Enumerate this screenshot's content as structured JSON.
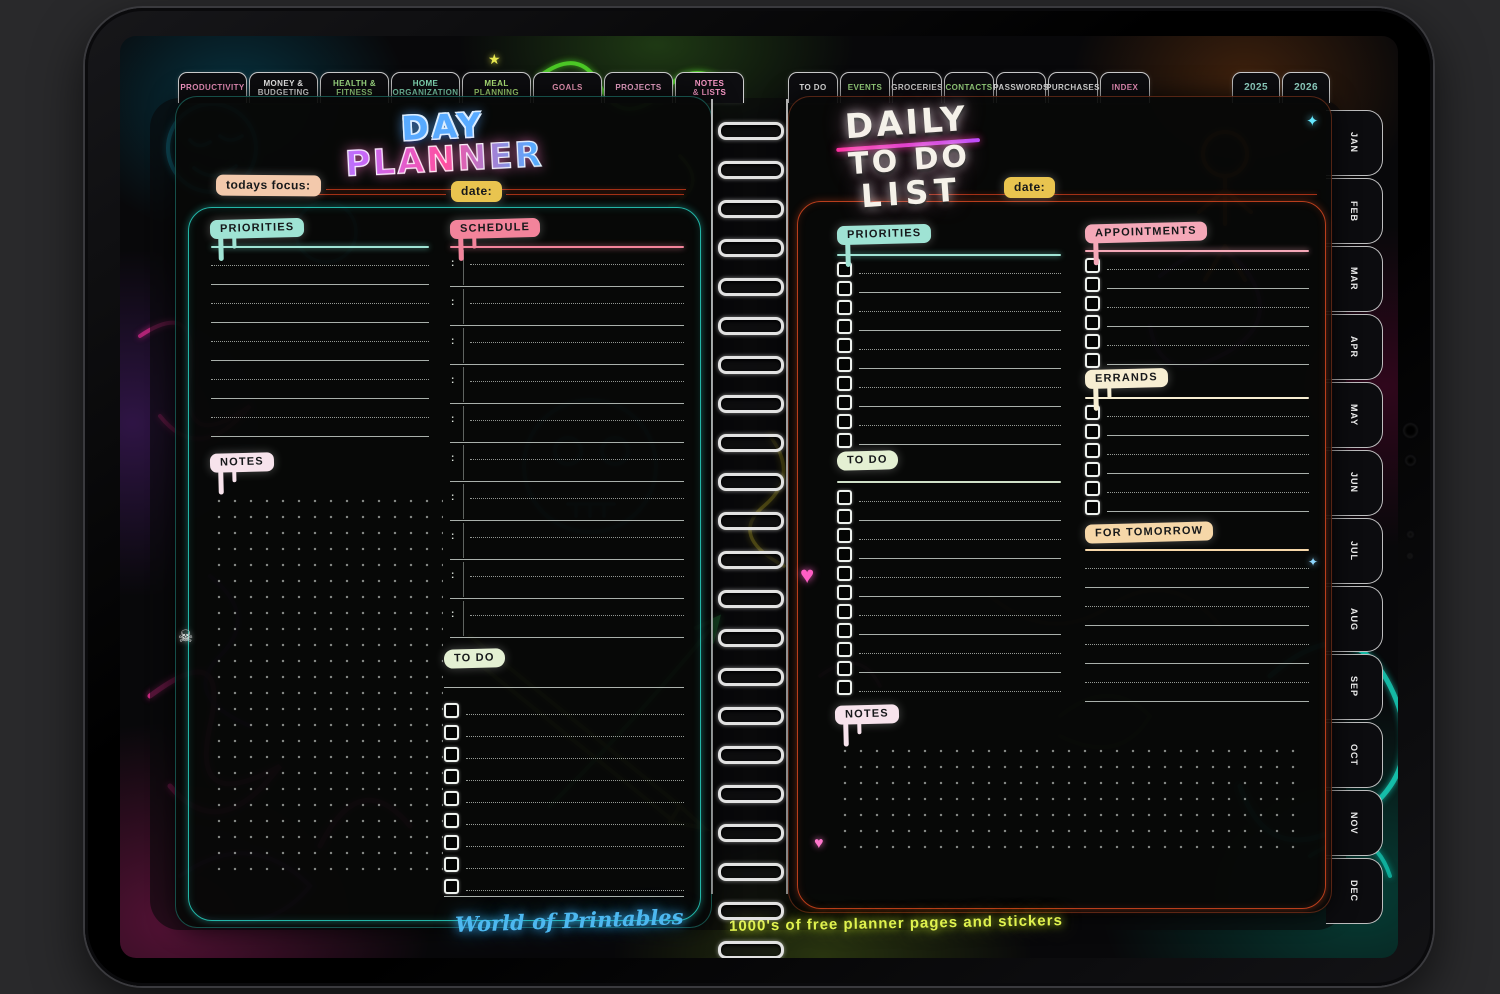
{
  "top_tabs_left": [
    {
      "label": "PRODUCTIVITY",
      "color": "#ff9ccb"
    },
    {
      "label": "MONEY &\nBUDGETING",
      "color": "#f3f3f3"
    },
    {
      "label": "HEALTH &\nFITNESS",
      "color": "#a8e98c"
    },
    {
      "label": "HOME\nORGANIZATION",
      "color": "#8ce9c2"
    },
    {
      "label": "MEAL\nPLANNING",
      "color": "#b6ef7e"
    },
    {
      "label": "GOALS",
      "color": "#ffa3c6"
    },
    {
      "label": "PROJECTS",
      "color": "#ffb0d9"
    },
    {
      "label": "NOTES\n& LISTS",
      "color": "#ff9ccb"
    }
  ],
  "top_tabs_right": [
    {
      "label": "TO DO",
      "color": "#f3f3f3"
    },
    {
      "label": "EVENTS",
      "color": "#a8e98c"
    },
    {
      "label": "GROCERIES",
      "color": "#e6e6e6"
    },
    {
      "label": "CONTACTS",
      "color": "#a8e98c"
    },
    {
      "label": "PASSWORDS",
      "color": "#f3f3f3"
    },
    {
      "label": "PURCHASES",
      "color": "#f3f3f3"
    },
    {
      "label": "INDEX",
      "color": "#ff9ccb"
    }
  ],
  "year_tabs": [
    {
      "label": "2025",
      "color": "#9fe8d8"
    },
    {
      "label": "2026",
      "color": "#9fe8d8"
    }
  ],
  "month_tabs": [
    "JAN",
    "FEB",
    "MAR",
    "APR",
    "MAY",
    "JUN",
    "JUL",
    "AUG",
    "SEP",
    "OCT",
    "NOV",
    "DEC"
  ],
  "left_page": {
    "title_line1": "DAY",
    "title_line2": "PLANNER",
    "focus_label": "todays focus:",
    "date_label": "date:",
    "priorities": {
      "label": "PRIORITIES",
      "accent": "#9fe3d4",
      "rows": 10
    },
    "schedule": {
      "label": "SCHEDULE",
      "accent": "#f2849b",
      "rows": 10
    },
    "notes": {
      "label": "NOTES",
      "accent": "#f7e3ec"
    },
    "todo": {
      "label": "TO DO",
      "accent": "#e4f0d3",
      "rows": 9
    }
  },
  "right_page": {
    "title_line1": "DAILY",
    "title_line2": "TO DO",
    "title_line3": "LIST",
    "date_label": "date:",
    "priorities": {
      "label": "PRIORITIES",
      "accent": "#9fe3d4",
      "rows": 10
    },
    "todo": {
      "label": "TO DO",
      "accent": "#e4f0d3",
      "rows": 11
    },
    "notes": {
      "label": "NOTES",
      "accent": "#f7e3ec"
    },
    "appointments": {
      "label": "APPOINTMENTS",
      "accent": "#f5a8b8",
      "rows": 6
    },
    "errands": {
      "label": "ERRANDS",
      "accent": "#f7eed2",
      "rows": 6
    },
    "tomorrow": {
      "label": "FOR TOMORROW",
      "accent": "#f6d7a8",
      "rows": 8
    }
  },
  "footer": {
    "brand": "World of Printables",
    "tagline": "1000's of free planner pages and stickers"
  },
  "colors": {
    "left_page_border": "#28d3c3",
    "right_page_border": "#d84820",
    "date_badge": "#e9c44f",
    "focus_badge": "#f3c9ac"
  },
  "stickers": [
    {
      "name": "heart-icon",
      "glyph": "♥",
      "color": "#ff5ec4"
    },
    {
      "name": "small-heart-icon",
      "glyph": "♥",
      "color": "#ff77cc"
    },
    {
      "name": "skull-icon",
      "glyph": "☠",
      "color": "#e8e8e8"
    },
    {
      "name": "sparkle-icon",
      "glyph": "✦",
      "color": "#66e8ff"
    },
    {
      "name": "star-icon",
      "glyph": "★",
      "color": "#e8e84f"
    }
  ]
}
